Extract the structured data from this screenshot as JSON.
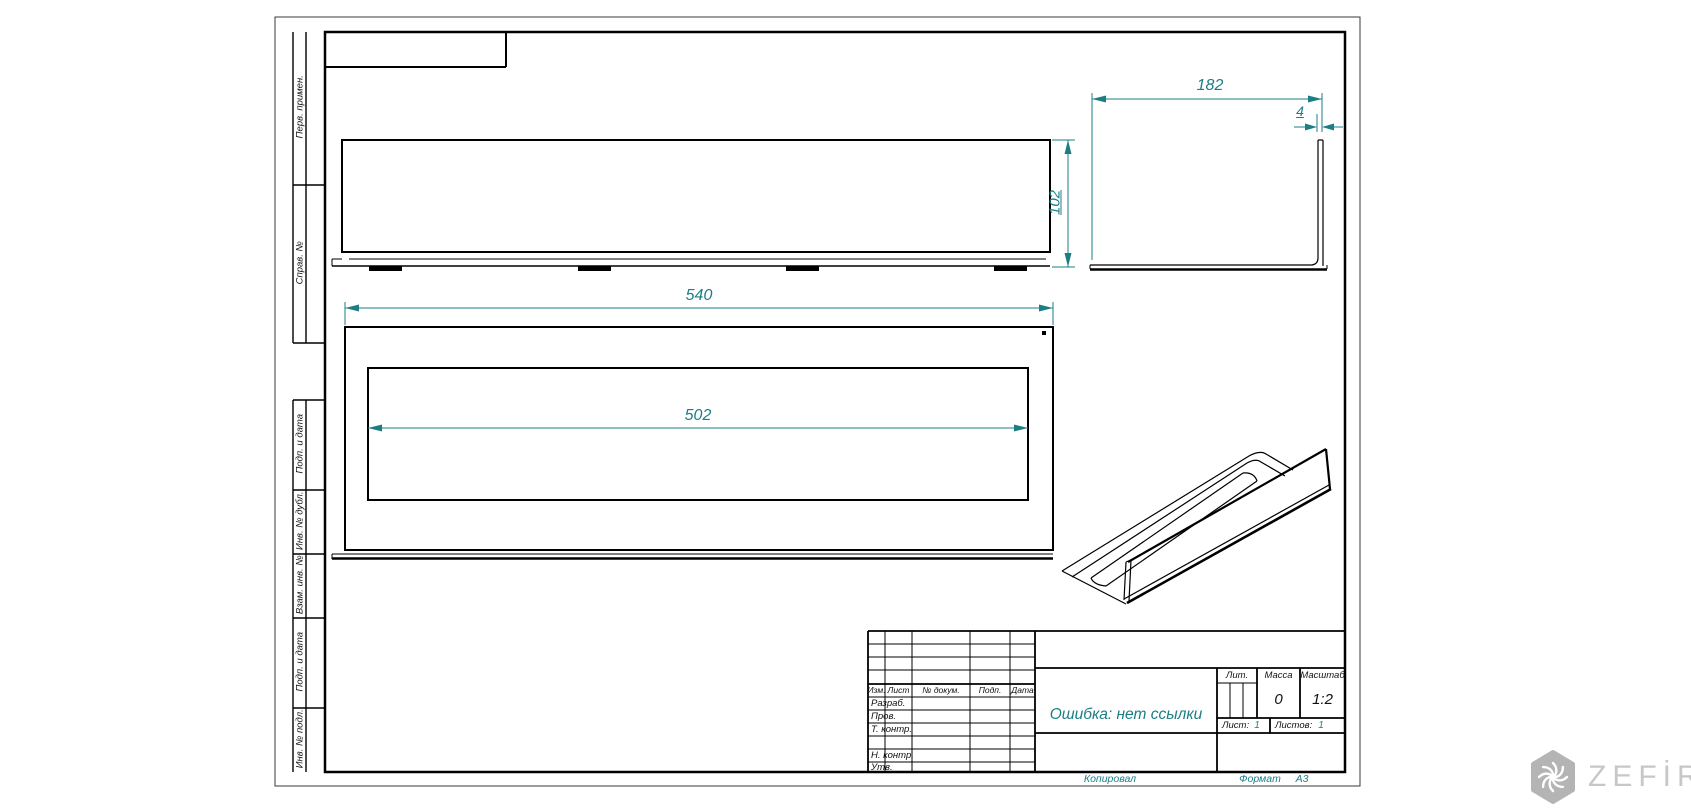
{
  "colors": {
    "dimension_teal": "#1b7e85",
    "line_black": "#000000",
    "logo_gray": "#b4b4b4"
  },
  "drawing": {
    "dimensions": {
      "top_view_height": "102",
      "front_width": "540",
      "front_opening_width": "502",
      "side_depth": "182",
      "flange_thickness": "4"
    }
  },
  "margin_column_labels": [
    "Перв. примен.",
    "Справ. №",
    "Подп. и дата",
    "Инв. № дубл.",
    "Взам. инв. №",
    "Подп. и дата",
    "Инв. № подл."
  ],
  "title_block": {
    "change_table_headers": [
      "Изм.",
      "Лист",
      "№ докум.",
      "Подп.",
      "Дата"
    ],
    "signature_rows": [
      "Разраб.",
      "Пров.",
      "Т. контр.",
      "",
      "Н. контр.",
      "Утв."
    ],
    "document_name": "Ошибка: нет ссылки",
    "literal_label": "Лит.",
    "mass_label": "Масса",
    "mass_value": "0",
    "scale_label": "Масштаб",
    "scale_value": "1:2",
    "sheet_label": "Лист:",
    "sheet_value": "1",
    "sheets_label": "Листов:",
    "sheets_value": "1"
  },
  "footer": {
    "copied_label": "Копировал",
    "format_label": "Формат",
    "format_value": "А3"
  },
  "logo": {
    "text": "ZEFİRE"
  }
}
